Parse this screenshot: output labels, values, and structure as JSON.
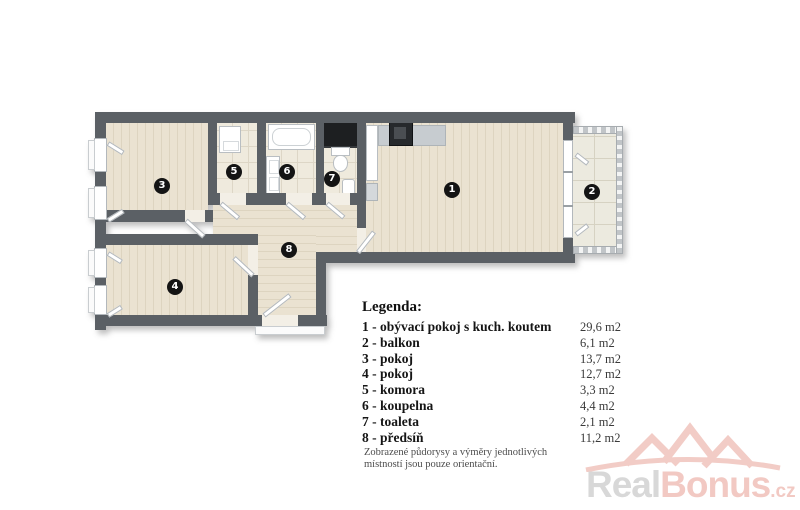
{
  "plan": {
    "room_labels": {
      "r1": "1",
      "r2": "2",
      "r3": "3",
      "r4": "4",
      "r5": "5",
      "r6": "6",
      "r7": "7",
      "r8": "8"
    }
  },
  "legend": {
    "title": "Legenda:",
    "items": [
      {
        "label": "1 - obývací pokoj s kuch. koutem",
        "area": "29,6 m2"
      },
      {
        "label": "2 - balkon",
        "area": "6,1 m2"
      },
      {
        "label": "3 - pokoj",
        "area": "13,7 m2"
      },
      {
        "label": "4 - pokoj",
        "area": "12,7 m2"
      },
      {
        "label": "5 - komora",
        "area": "3,3 m2"
      },
      {
        "label": "6 - koupelna",
        "area": "4,4 m2"
      },
      {
        "label": "7 - toaleta",
        "area": "2,1 m2"
      },
      {
        "label": "8 - předsíň",
        "area": "11,2 m2"
      }
    ],
    "disclaimer": [
      "Zobrazené půdorysy a výměry jednotlivých",
      "místností jsou pouze orientační."
    ]
  },
  "watermark": {
    "part1": "Real",
    "part2": "Bonus",
    "part3": ".cz"
  },
  "colors": {
    "wall": "#5b6065",
    "wood": "#eae2d1",
    "tile": "#efeadd",
    "wm-pink": "#f2c9c3",
    "wm-gray": "#d8d8d8"
  }
}
